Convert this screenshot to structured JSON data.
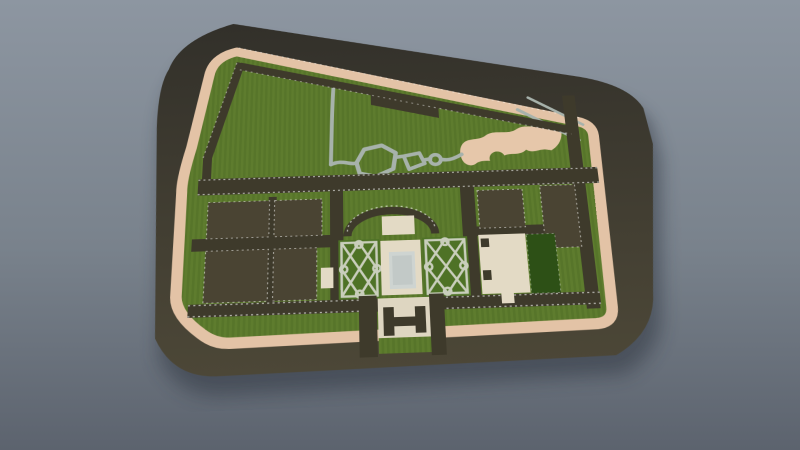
{
  "scene": {
    "kind": "3d-render",
    "subject": "aerial perspective render of a walled park / garden site plan on a dark ground slab",
    "background": "blue-gray gradient sky, no UI chrome, no visible text"
  },
  "colors": {
    "bg-top": "#8d96a1",
    "bg-mid": "#79828c",
    "bg-bottom": "#5c636e",
    "shadow": "#2e3540",
    "slab-top": "#32302a",
    "slab-bottom": "#4c4737",
    "path-tan": "#e3c3a6",
    "lawn-a": "#57752a",
    "lawn-b": "#5e7c2e",
    "road": "#3e3a2b",
    "plot-olive": "#4a4433",
    "plot-green": "#2d5016",
    "path-gray": "#a7b2ab",
    "parterre-path": "#c9cebc",
    "parterre-green": "#4e7226",
    "plaza-cream": "#e3dac5",
    "plaza-entrance": "#ded6c1",
    "pool-border": "#ced4d1",
    "pool-fill": "#c2c9c7",
    "sand": "#e6c7aa"
  }
}
